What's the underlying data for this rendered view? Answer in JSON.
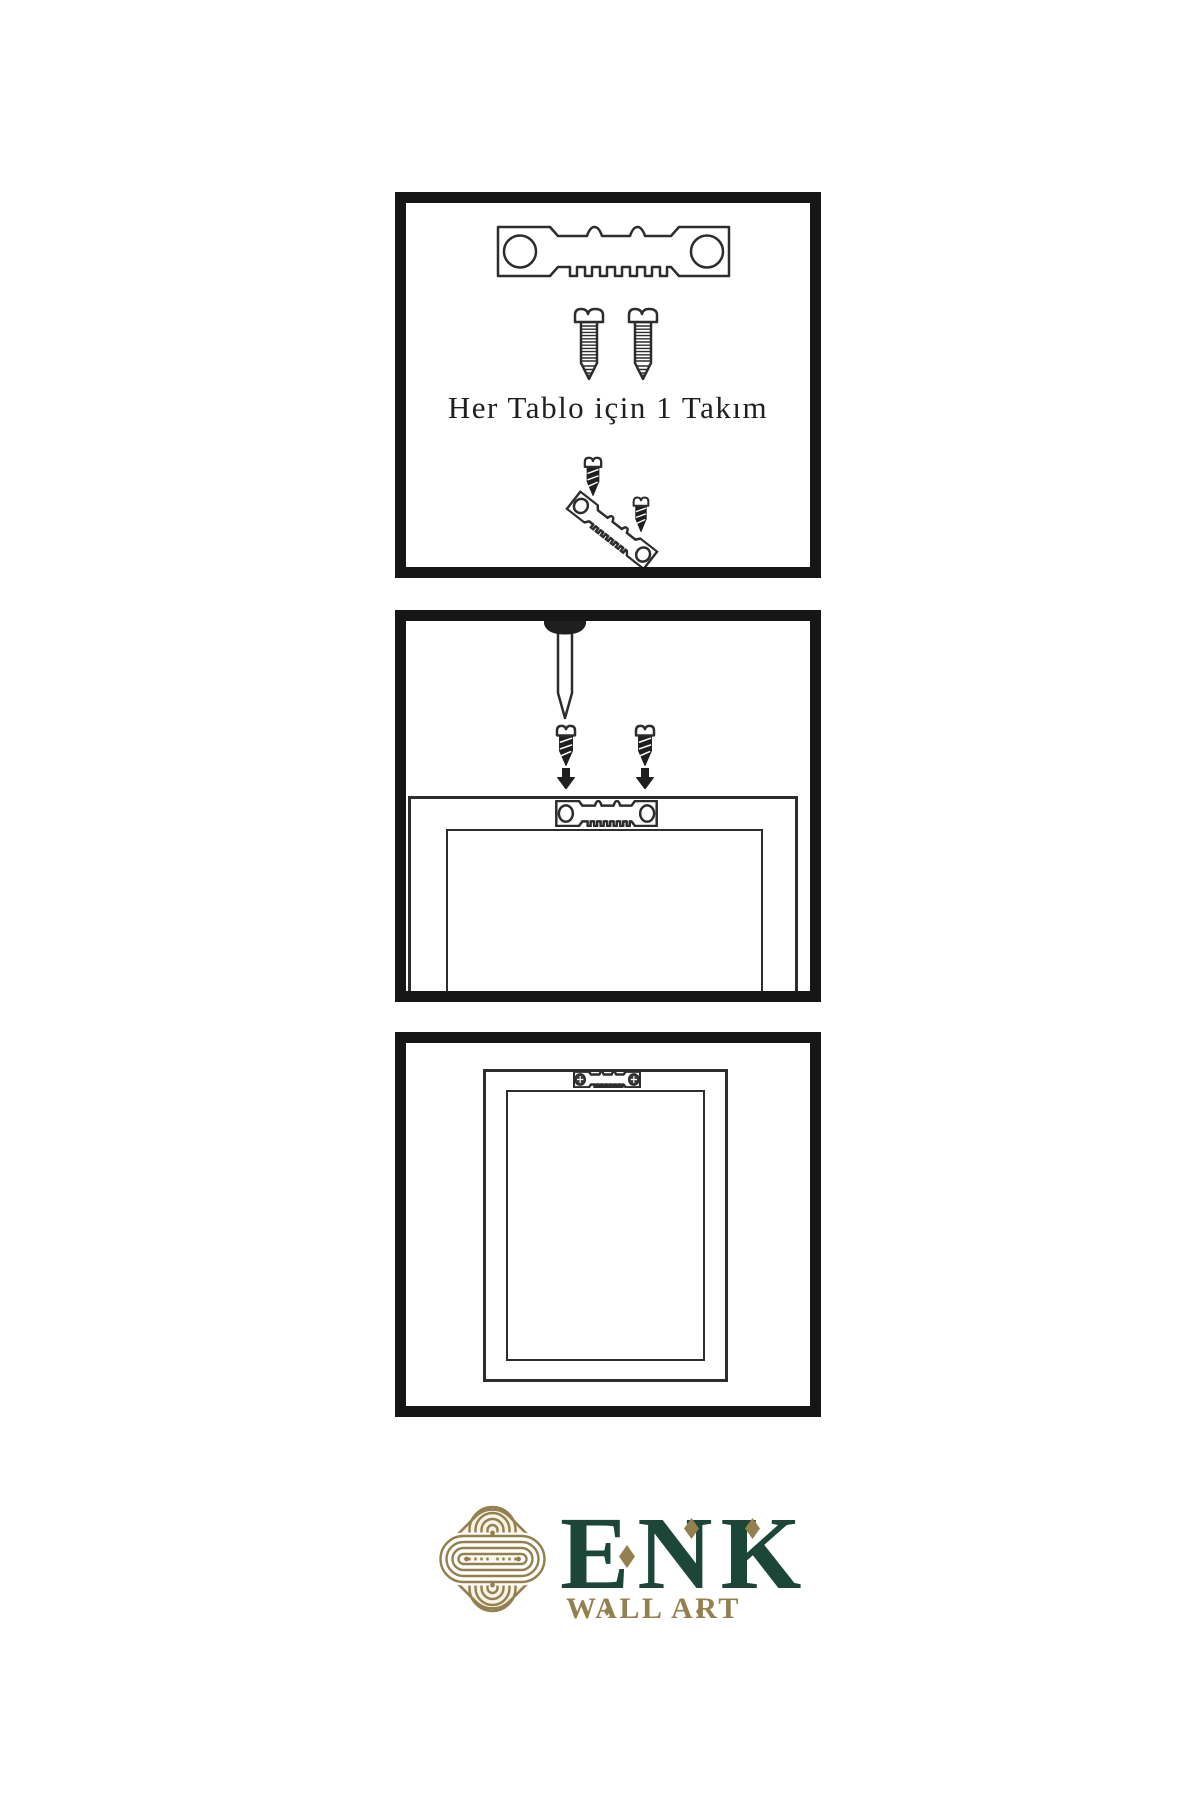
{
  "page": {
    "background": "#ffffff",
    "width": 1200,
    "height": 1800
  },
  "colors": {
    "panel_border": "#161616",
    "outline": "#2d2d2d",
    "dark_fill": "#1f1f1f",
    "caption_text": "#1f1f1f",
    "brand_green": "#1b4638",
    "brand_gold": "#94804e",
    "emblem_fill": "#f8f3e7"
  },
  "steps": [
    {
      "name": "hardware-kit",
      "caption": "Her Tablo için 1 Takım",
      "icons": [
        "sawtooth-hanger-icon",
        "screw-icon",
        "screw-icon",
        "dark-screw-icon",
        "tilted-sawtooth-hanger-icon",
        "dark-screw-icon"
      ]
    },
    {
      "name": "mounting-on-wall",
      "icons": [
        "wall-nail-icon",
        "dark-screw-icon",
        "dark-screw-icon",
        "down-arrow-icon",
        "down-arrow-icon",
        "frame-back-icon",
        "sawtooth-hanger-icon"
      ]
    },
    {
      "name": "hung-frame",
      "icons": [
        "frame-front-icon",
        "sawtooth-hanger-icon",
        "phillips-screw-head-icon",
        "phillips-screw-head-icon"
      ]
    }
  ],
  "brand": {
    "name": "ENK",
    "tagline": "WALL ART",
    "emblem": "interlaced-knot"
  }
}
